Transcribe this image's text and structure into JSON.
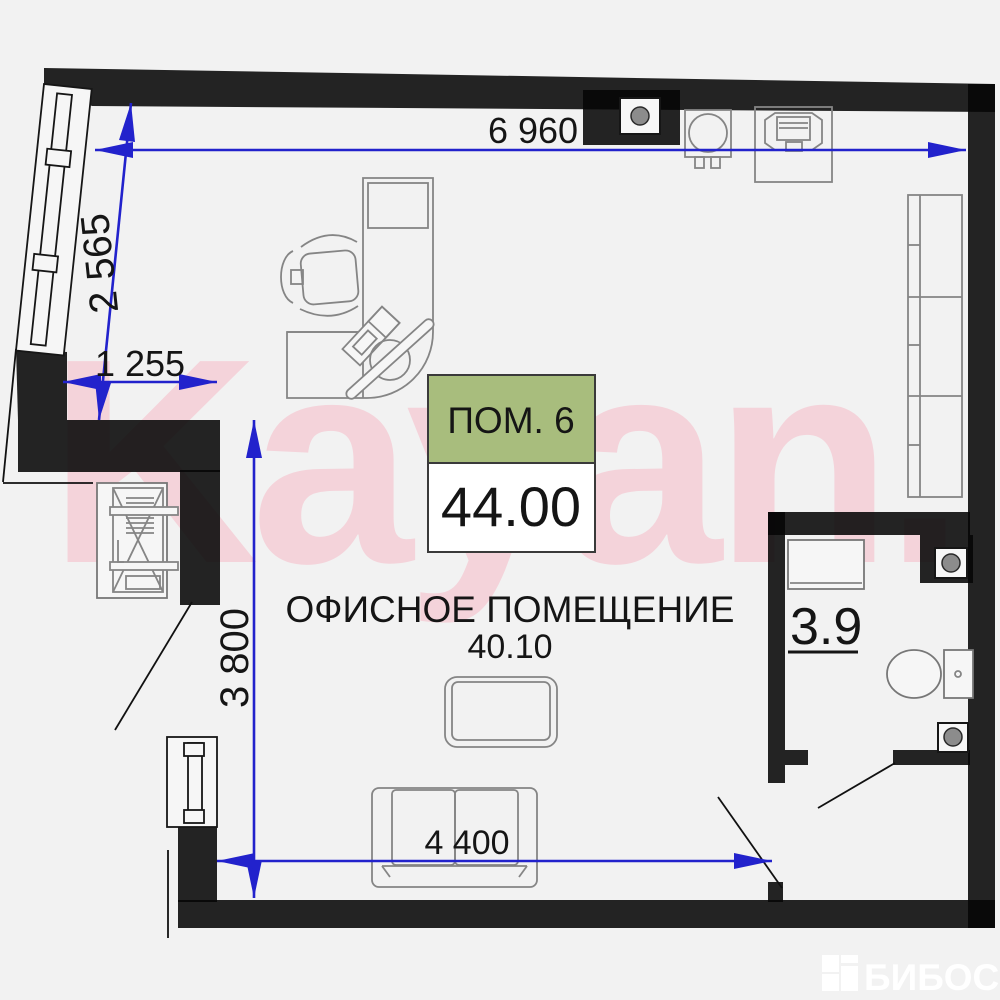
{
  "plan": {
    "watermark_text": "Kayan.",
    "brand_text": "БИБОСС",
    "room_label": {
      "name": "ПОМ. 6",
      "area_value": "44.00"
    },
    "room_title": {
      "name": "ОФИСНОЕ ПОМЕЩЕНИЕ",
      "area_value": "40.10"
    },
    "bathroom": {
      "area_value": "3.9"
    },
    "dimensions": {
      "top_width": "6 960",
      "left_upper": "2 565",
      "left_inset": "1 255",
      "left_lower": "3 800",
      "bottom_width": "4 400"
    },
    "colors": {
      "background": "#f2f2f2",
      "walls": "#060606",
      "dimension_blue": "#2222cc",
      "label_green": "#a8bd7d",
      "watermark_pink": "#f4d3da",
      "furniture_gray": "#858585",
      "brand_white": "#ffffff"
    }
  }
}
